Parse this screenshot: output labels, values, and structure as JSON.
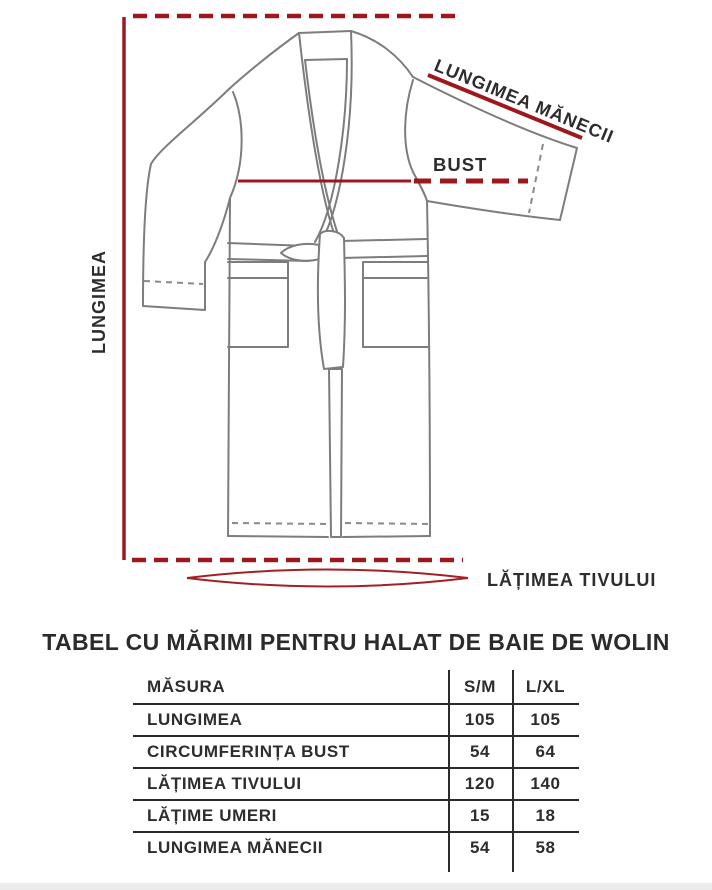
{
  "diagram": {
    "labels": {
      "length": "LUNGIMEA",
      "sleeve_length": "LUNGIMEA MĂNECII",
      "bust": "BUST",
      "hem_width": "LĂȚIMEA TIVULUI"
    },
    "colors": {
      "annotation_red": "#9c181d",
      "ellipse_red": "#a32024",
      "outline_gray": "#7d7d7d",
      "stitch_gray": "#8a8a8a",
      "text_dark": "#2d2d2d"
    }
  },
  "title": "TABEL CU MĂRIMI PENTRU HALAT DE BAIE DE WOLIN",
  "table": {
    "columns": [
      "MĂSURA",
      "S/M",
      "L/XL"
    ],
    "rows": [
      {
        "label": "LUNGIMEA",
        "sm": "105",
        "lxl": "105"
      },
      {
        "label": "CIRCUMFERINȚA BUST",
        "sm": "54",
        "lxl": "64"
      },
      {
        "label": "LĂȚIMEA TIVULUI",
        "sm": "120",
        "lxl": "140"
      },
      {
        "label": "LĂȚIME UMERI",
        "sm": "15",
        "lxl": "18"
      },
      {
        "label": "LUNGIMEA MĂNECII",
        "sm": "54",
        "lxl": "58"
      }
    ]
  }
}
